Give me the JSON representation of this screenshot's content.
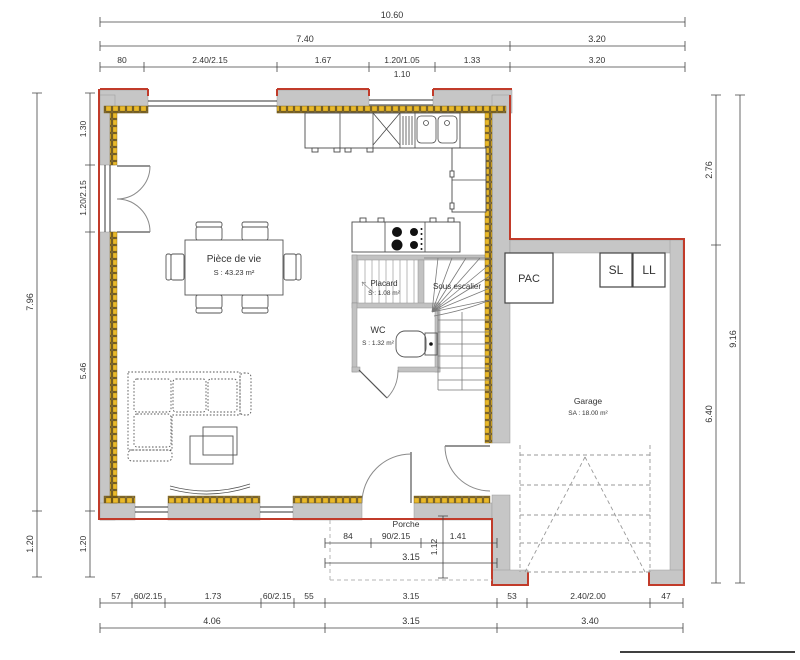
{
  "rooms": {
    "living": {
      "name": "Pièce de vie",
      "area": "S : 43.23 m²"
    },
    "placard": {
      "name": "Placard",
      "area": "S : 1.08 m²"
    },
    "under_stairs": {
      "name": "Sous escalier"
    },
    "wc": {
      "name": "WC",
      "area": "S : 1.32 m²"
    },
    "garage": {
      "name": "Garage",
      "area": "SA : 18.00 m²"
    },
    "porch": {
      "name": "Porche"
    }
  },
  "equipment": {
    "pac": "PAC",
    "dryer": "SL",
    "washer": "LL"
  },
  "dimensions": {
    "top": {
      "total": "10.60",
      "main": "7.40",
      "garage": "3.20",
      "detail": [
        "80",
        "2.40/2.15",
        "1.67",
        "1.20/1.05",
        "1.33",
        "3.20"
      ],
      "sub": "1.10"
    },
    "left": {
      "outer": [
        "7.96",
        "1.20"
      ],
      "inner": [
        "1.30",
        "1.20/2.15",
        "5.46",
        "1.20"
      ]
    },
    "right": {
      "inner": [
        "2.76",
        "6.40"
      ],
      "outer": "9.16"
    },
    "bottom": {
      "detail": [
        "57",
        "60/2.15",
        "1.73",
        "60/2.15",
        "55",
        "3.15",
        "53",
        "2.40/2.00",
        "47"
      ],
      "totals": [
        "4.06",
        "3.15",
        "3.40"
      ]
    },
    "porch": {
      "segments": [
        "84",
        "90/2.15",
        "1.41"
      ],
      "depth": "1.12",
      "width": "3.15"
    }
  },
  "colors": {
    "wall": "#c6c6c6",
    "outline": "#c13b2a",
    "insulation": "#e9b92a"
  }
}
